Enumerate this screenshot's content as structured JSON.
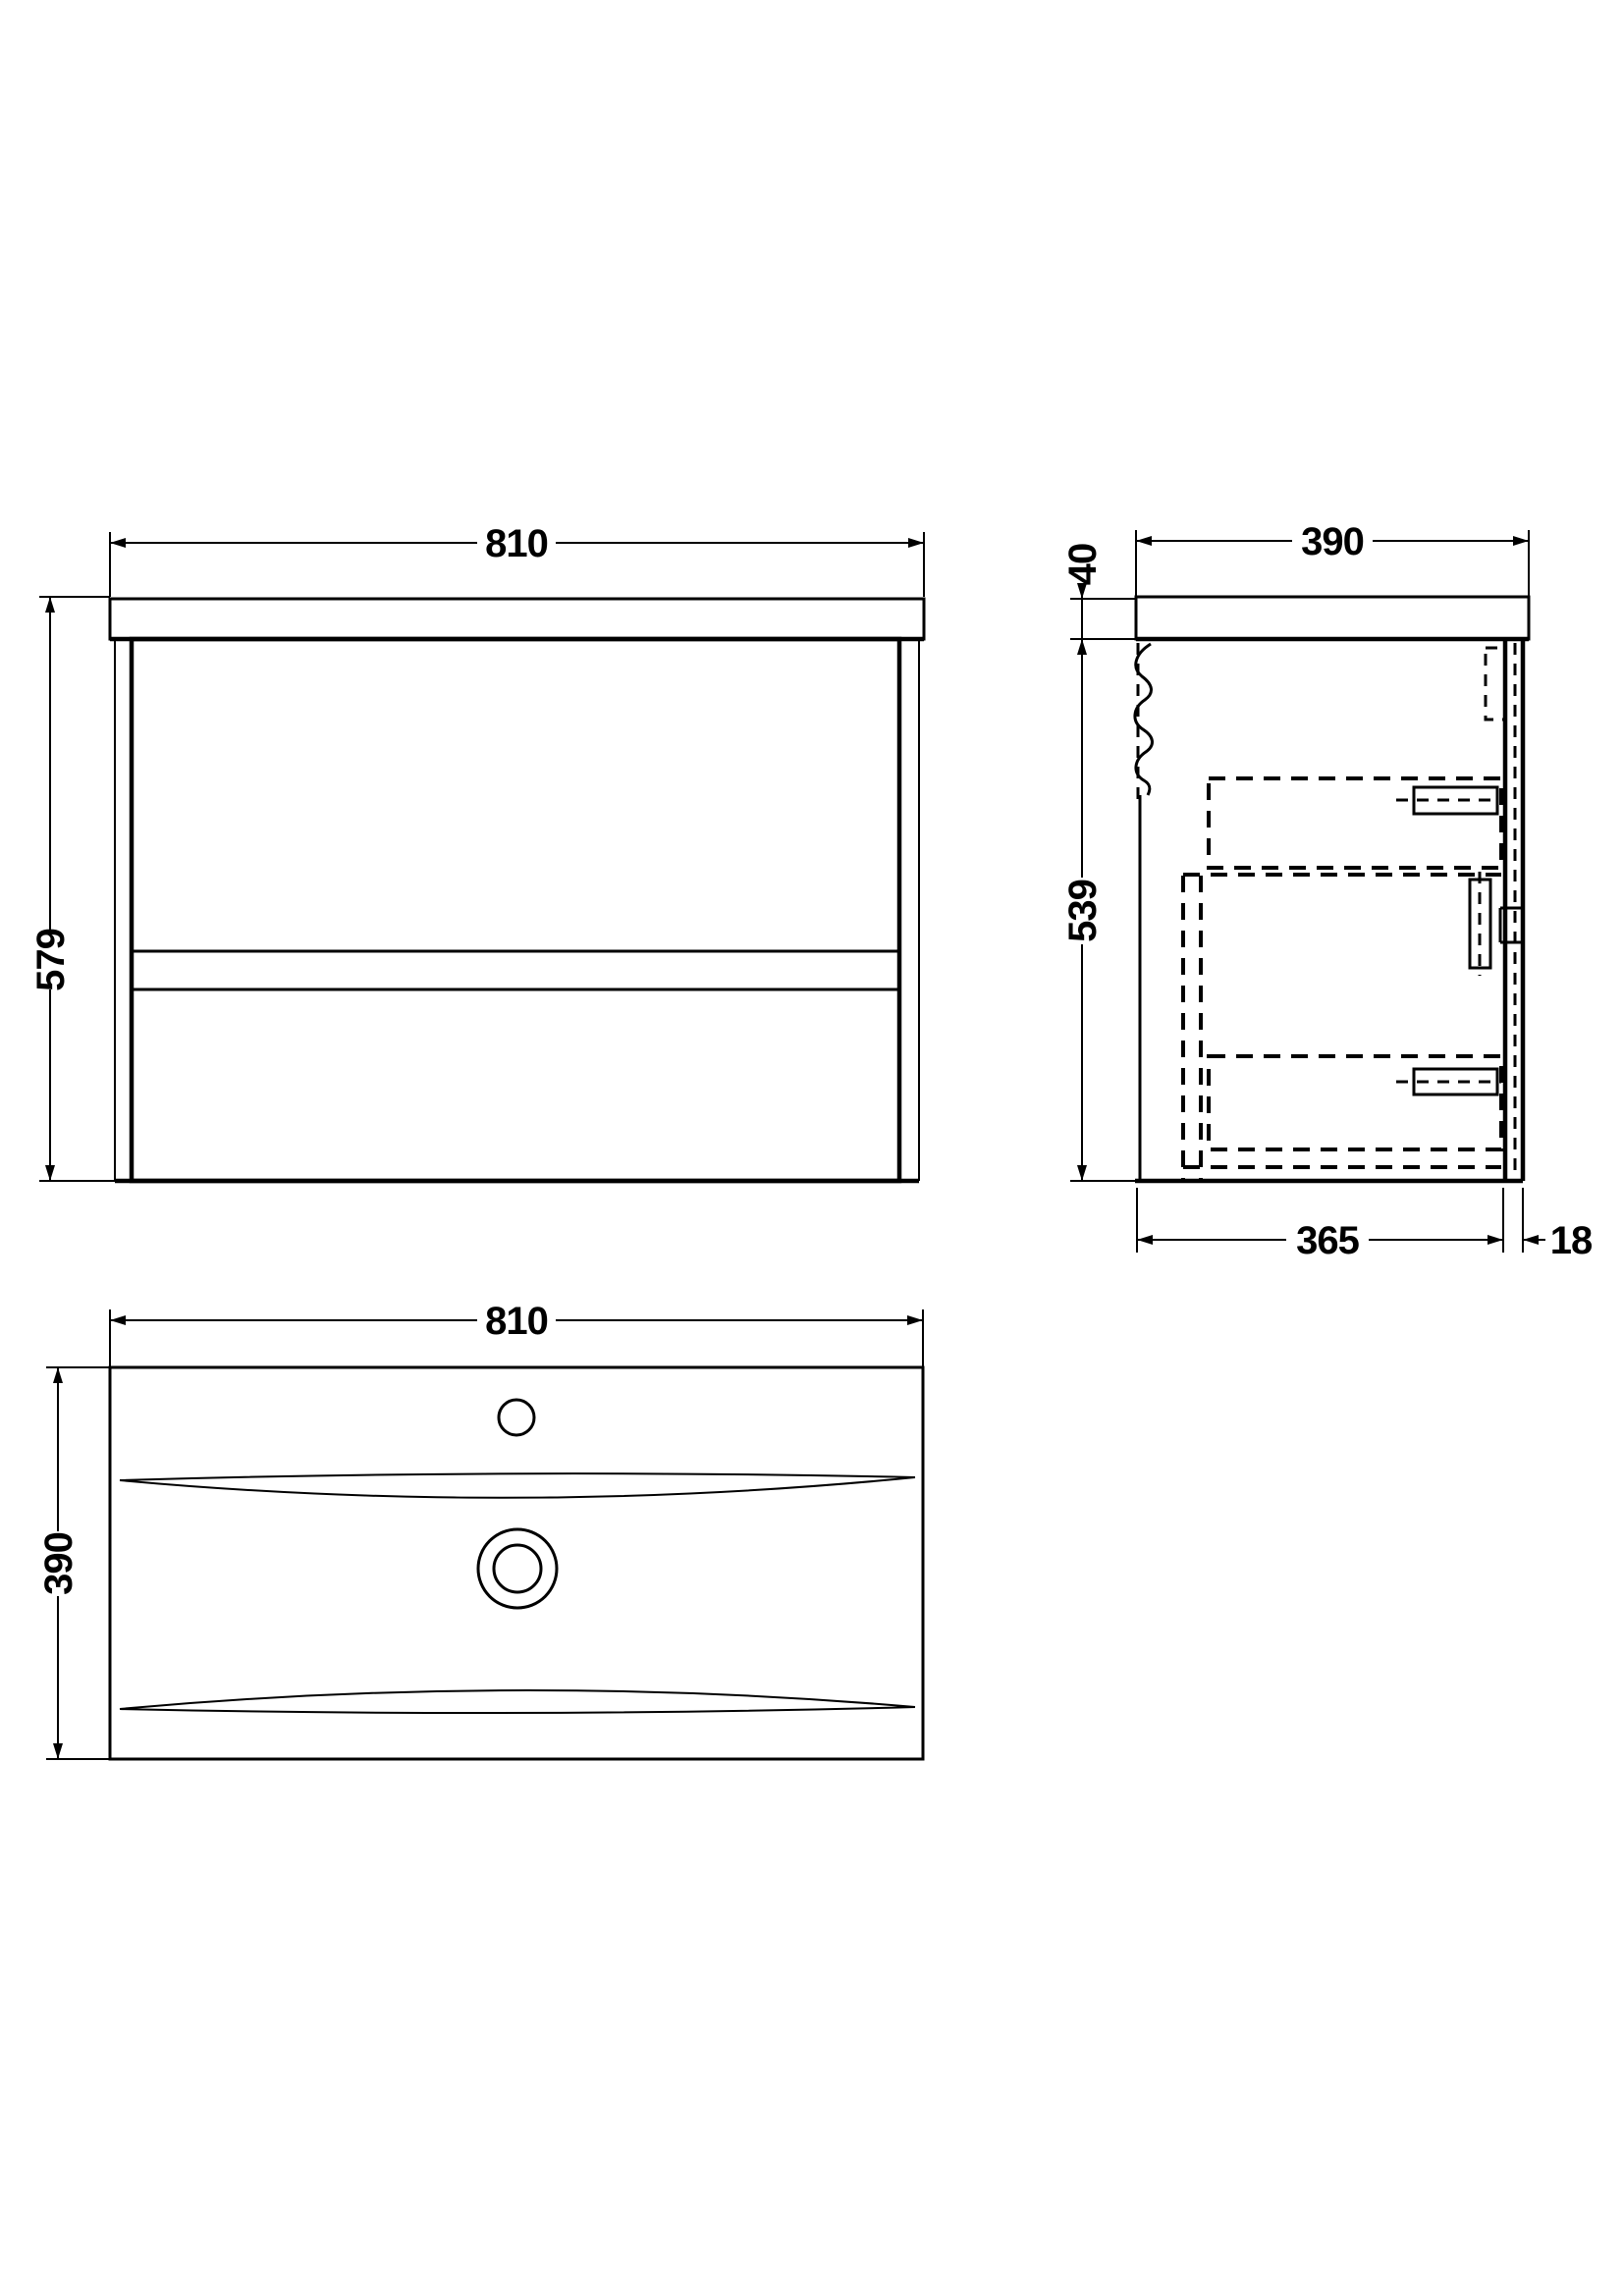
{
  "page": {
    "background_color": "#ffffff",
    "line_color": "#000000"
  },
  "dims": {
    "front_width": "810",
    "front_height": "579",
    "side_depth": "390",
    "side_worktop_thickness": "40",
    "side_cabinet_height": "539",
    "side_carcass_depth": "365",
    "side_front_panel_thickness": "18",
    "basin_width": "810",
    "basin_depth": "390"
  }
}
